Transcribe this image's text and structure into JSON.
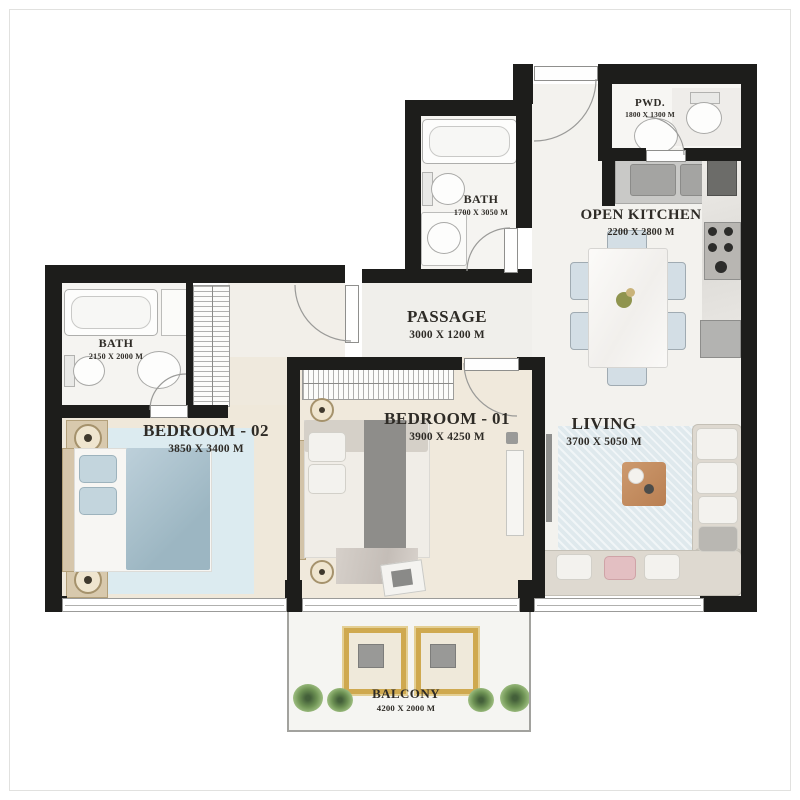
{
  "plan": {
    "title": "apartment-floor-plan",
    "rooms": {
      "pwd": {
        "name": "PWD.",
        "dims": "1800 X 1300 M"
      },
      "bath_top": {
        "name": "BATH",
        "dims": "1700 X 3050 M"
      },
      "kitchen": {
        "name": "OPEN KITCHEN",
        "dims": "2200 X 2800 M"
      },
      "passage": {
        "name": "PASSAGE",
        "dims": "3000 X 1200 M"
      },
      "bath_left": {
        "name": "BATH",
        "dims": "2150 X 2000 M"
      },
      "bedroom2": {
        "name": "BEDROOM - 02",
        "dims": "3850 X 3400 M"
      },
      "bedroom1": {
        "name": "BEDROOM - 01",
        "dims": "3900 X 4250 M"
      },
      "living": {
        "name": "LIVING",
        "dims": "3700 X 5050 M"
      },
      "balcony": {
        "name": "BALCONY",
        "dims": "4200 X 2000 M"
      }
    },
    "colors": {
      "wall": "#1d1d1b",
      "bedroom_floor_cream": "#efe8da",
      "marble_floor": "#f5f4f1",
      "rug_blue": "#dcebf0",
      "duvet_blue": "#aec6d2",
      "sofa_beige": "#ded9d0",
      "accent_pink_pillow": "#e3bfc2",
      "coffee_table_wood": "#c38d64",
      "balcony_chair_gold": "#cfa94f",
      "plant_green": "#6f9455"
    }
  }
}
